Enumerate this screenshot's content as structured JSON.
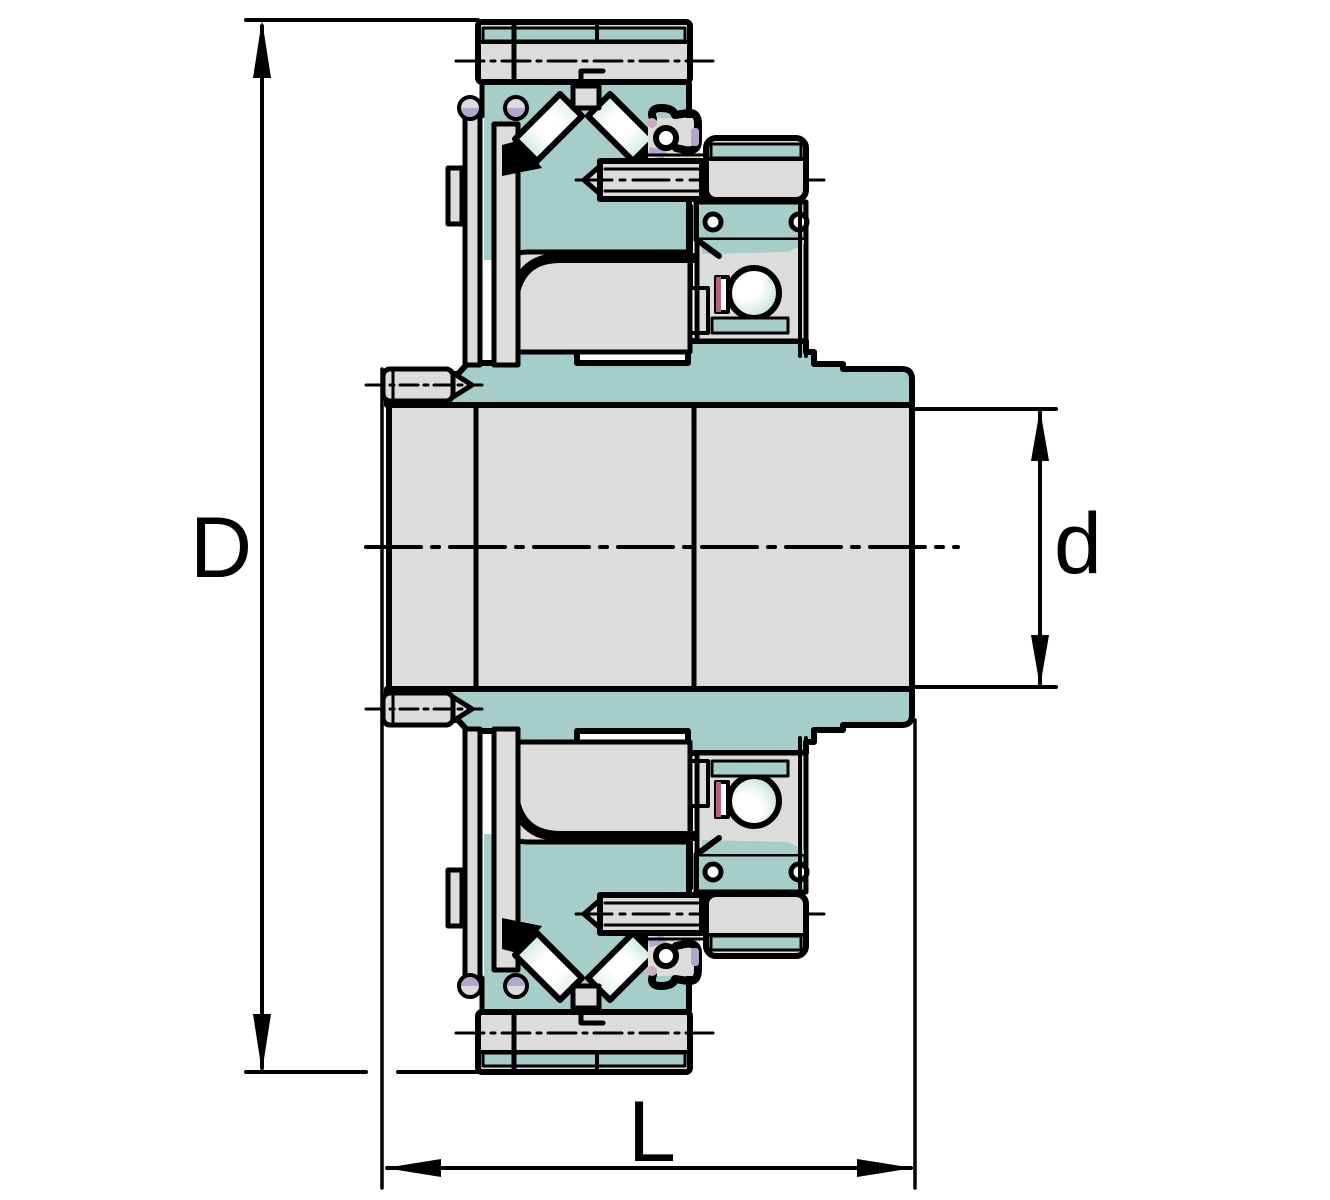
{
  "drawing": {
    "kind": "bearing-unit-cross-section",
    "dimension_labels": {
      "outer_diameter": "D",
      "bore_diameter": "d",
      "overall_length": "L"
    },
    "colors": {
      "teal": "#a7cdc9",
      "light_gray": "#dcdddb",
      "outline": "#000000",
      "mint": "#d8ece6",
      "roller_end": "#bfe0d8",
      "lavender": "#b2a6cf",
      "mauve": "#c9afc1",
      "dark_pink": "#b2637a",
      "ball_edge": "#b9ddd5",
      "background": "#ffffff"
    }
  }
}
